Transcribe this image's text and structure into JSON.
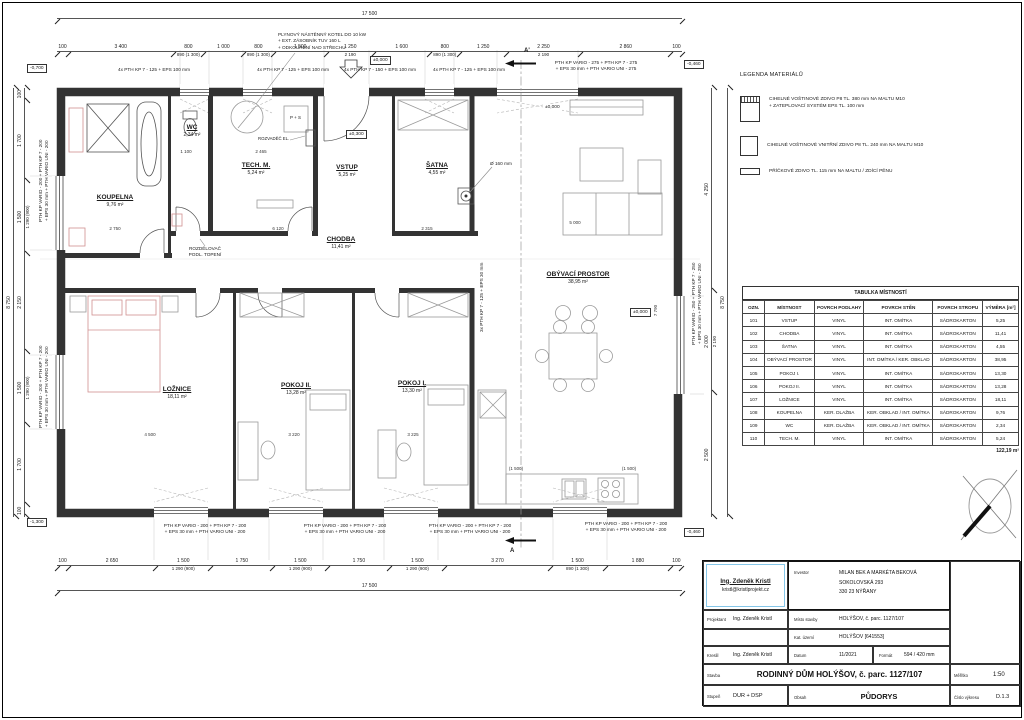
{
  "legend": {
    "title": "LEGENDA MATERIÁLŮ",
    "items": [
      {
        "symbol": "wall-exterior-insulated",
        "line1": "CIHELNÉ VOŠTINOVÉ ZDIVO P8 TL. 380 mm NA MALTU M10",
        "line2": "+ ZATEPLOVACÍ SYSTÉM EPS TL. 100 mm"
      },
      {
        "symbol": "wall-interior-240",
        "line1": "CIHELNÉ VOŠTINOVÉ VNITŘNÍ ZDIVO P8 TL. 240 mm NA MALTU M10",
        "line2": ""
      },
      {
        "symbol": "wall-partition-115",
        "line1": "PŘÍČKOVÉ ZDIVO TL. 115 mm NA MALTU / ZDÍCÍ PĚNU",
        "line2": ""
      }
    ]
  },
  "room_table": {
    "title": "TABULKA MÍSTNOSTÍ",
    "columns": [
      "OZN.",
      "MÍSTNOST",
      "POVRCH PODLAHY",
      "POVRCH STĚN",
      "POVRCH STROPU",
      "VÝMĚRA [m²]"
    ],
    "rows": [
      [
        "101",
        "VSTUP",
        "VINYL",
        "INT. OMÍTKA",
        "SÁDROKARTON",
        "5,25"
      ],
      [
        "102",
        "CHODBA",
        "VINYL",
        "INT. OMÍTKA",
        "SÁDROKARTON",
        "11,41"
      ],
      [
        "103",
        "ŠATNA",
        "VINYL",
        "INT. OMÍTKA",
        "SÁDROKARTON",
        "4,55"
      ],
      [
        "104",
        "OBÝVACÍ PROSTOR",
        "VINYL",
        "INT. OMÍTKA / KER. OBKLAD",
        "SÁDROKARTON",
        "38,95"
      ],
      [
        "105",
        "POKOJ I.",
        "VINYL",
        "INT. OMÍTKA",
        "SÁDROKARTON",
        "13,30"
      ],
      [
        "106",
        "POKOJ II.",
        "VINYL",
        "INT. OMÍTKA",
        "SÁDROKARTON",
        "13,28"
      ],
      [
        "107",
        "LOŽNICE",
        "VINYL",
        "INT. OMÍTKA",
        "SÁDROKARTON",
        "18,11"
      ],
      [
        "108",
        "KOUPELNA",
        "KER. DLAŽBA",
        "KER. OBKLAD / INT. OMÍTKA",
        "SÁDROKARTON",
        "9,76"
      ],
      [
        "109",
        "WC",
        "KER. DLAŽBA",
        "KER. OBKLAD / INT. OMÍTKA",
        "SÁDROKARTON",
        "2,34"
      ],
      [
        "110",
        "TECH. M.",
        "VINYL",
        "INT. OMÍTKA",
        "SÁDROKARTON",
        "5,24"
      ]
    ],
    "total": "122,19 m²"
  },
  "title_block": {
    "designer_name": "Ing. Zdeněk Kristl",
    "designer_email": "kristl@kristlprojekt.cz",
    "investor_label": "Investor",
    "investor_line1": "MILAN BEK A MARKÉTA BEKOVÁ",
    "investor_line2": "SOKOLOVSKÁ 293",
    "investor_line3": "330 23 NÝŘANY",
    "projektant_label": "Projektant",
    "projektant": "Ing. Zdeněk Kristl",
    "misto_label": "Místo stavby",
    "misto": "HOLÝŠOV, č. parc. 1127/107",
    "kat_label": "Kat. území",
    "kat": "HOLÝŠOV [641553]",
    "kreslil_label": "Kreslil",
    "kreslil": "Ing. Zdeněk Kristl",
    "datum_label": "Datum",
    "datum": "11/2021",
    "format_label": "Formát",
    "format": "594 / 420 mm",
    "stavba_label": "Stavba",
    "stavba": "RODINNÝ DŮM HOLÝŠOV, č. parc. 1127/107",
    "stupen_label": "Stupeň",
    "stupen": "DUR + DSP",
    "obsah_label": "Obsah",
    "obsah": "PŮDORYS",
    "meritko_label": "Měřítko",
    "meritko": "1:50",
    "cislo_label": "Číslo výkresu",
    "cislo": "D.1.3"
  },
  "plan": {
    "rooms": [
      {
        "name": "KOUPELNA",
        "area": "9,76 m²"
      },
      {
        "name": "WC",
        "area": "2,34 m²"
      },
      {
        "name": "TECH. M.",
        "area": "5,24 m²"
      },
      {
        "name": "VSTUP",
        "area": "5,25 m²"
      },
      {
        "name": "ŠATNA",
        "area": "4,55 m²"
      },
      {
        "name": "CHODBA",
        "area": "11,41 m²"
      },
      {
        "name": "OBÝVACÍ PROSTOR",
        "area": "38,95 m²"
      },
      {
        "name": "LOŽNICE",
        "area": "18,11 m²"
      },
      {
        "name": "POKOJ II.",
        "area": "13,28 m²"
      },
      {
        "name": "POKOJ I.",
        "area": "13,30 m²"
      }
    ],
    "annotations": {
      "boiler_l1": "PLYNOVÝ NÁSTĚNNÝ KOTEL DO 10 kW",
      "boiler_l2": "+ EXT. ZÁSOBNÍK TUV 160 L",
      "boiler_l3": "+ ODKOUŘENÍ NAD STŘECHU",
      "rozvadec": "ROZVADĚČ EL.",
      "rozdelovac_l1": "ROZDĚLOVAČ",
      "rozdelovac_l2": "PODL. TOPENÍ",
      "ps": "P + S",
      "vent": "Ø 160 mm",
      "note_top_125": "4x PTH KP 7 - 125 + EPS 100 mm",
      "note_top_150": "4x PTH KP 7 - 150 + EPS 100 mm",
      "note_275_l1": "PTH KP VARIO - 275 + PTH KP 7 - 275",
      "note_275_l2": "+ EPS 30 mm + PTH VARIO UNI - 275",
      "note_200_l1": "PTH KP VARIO - 200 + PTH KP 7 - 200",
      "note_200_l2": "+ EPS 30 mm + PTH VARIO UNI - 200",
      "note_250_l1": "PTH KP VARIO - 250 + PTH KP 7 - 250",
      "note_250_l2": "+ EPS 30 mm + PTH VARIO UNI - 250",
      "note_interior": "3x PTH KP 7 - 125 + EPS 30 mm",
      "section_a": "A",
      "section_a_prime": "A'"
    },
    "levels": {
      "zero": "±0,000",
      "plus300": "±0,300",
      "m460": "-0,460",
      "m700": "-0,700",
      "m1300": "-1,300"
    },
    "dimensions": {
      "top_total": "17 500",
      "top": [
        {
          "v": "100",
          "w": 100
        },
        {
          "v": "3 400",
          "w": 3400
        },
        {
          "v": "800",
          "s": "890 (1 300)",
          "w": 800
        },
        {
          "v": "1 000",
          "w": 1000
        },
        {
          "v": "800",
          "s": "890 (1 300)",
          "w": 800
        },
        {
          "v": "1 500",
          "w": 1500
        },
        {
          "v": "1 250",
          "s": "2 190",
          "w": 1250
        },
        {
          "v": "1 600",
          "w": 1600
        },
        {
          "v": "800",
          "s": "890 (1 300)",
          "w": 800
        },
        {
          "v": "1 250",
          "w": 1250
        },
        {
          "v": "2 250",
          "s": "2 190",
          "w": 2250
        },
        {
          "v": "2 860",
          "w": 2860
        },
        {
          "v": "100",
          "w": 100
        }
      ],
      "bottom": [
        {
          "v": "100",
          "w": 100
        },
        {
          "v": "2 650",
          "w": 2650
        },
        {
          "v": "1 500",
          "s": "1 290 (900)",
          "w": 1500
        },
        {
          "v": "1 750",
          "w": 1750
        },
        {
          "v": "1 500",
          "s": "1 290 (900)",
          "w": 1500
        },
        {
          "v": "1 750",
          "w": 1750
        },
        {
          "v": "1 500",
          "s": "1 290 (900)",
          "w": 1500
        },
        {
          "v": "3 270",
          "w": 3270
        },
        {
          "v": "1 500",
          "s": "890 (1 300)",
          "w": 1500
        },
        {
          "v": "1 880",
          "w": 1880
        },
        {
          "v": "100",
          "w": 100
        }
      ],
      "bottom_total": "17 500",
      "left": [
        {
          "v": "100",
          "w": 100
        },
        {
          "v": "1 700",
          "w": 1700
        },
        {
          "v": "1 500",
          "s": "1 290 (900)",
          "w": 1500
        },
        {
          "v": "2 150",
          "w": 2150
        },
        {
          "v": "1 500",
          "s": "1 290 (900)",
          "w": 1500
        },
        {
          "v": "1 700",
          "w": 1700
        },
        {
          "v": "100",
          "w": 100
        }
      ],
      "left_total": "8 750",
      "right": [
        {
          "v": "4 250",
          "w": 4250
        },
        {
          "v": "2 000",
          "s": "2 190",
          "w": 2000
        },
        {
          "v": "2 500",
          "w": 2500
        }
      ],
      "right_total": "8 750",
      "interior": [
        "2 750",
        "1 100",
        "2 465",
        "6 120",
        "2 315",
        "5 000",
        "4 500",
        "3 220",
        "3 225",
        "7 790",
        "(1 500)",
        "(1 500)"
      ]
    }
  }
}
